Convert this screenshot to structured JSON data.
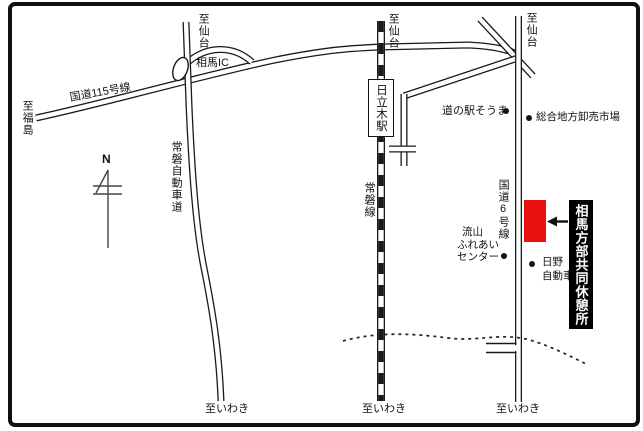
{
  "map": {
    "compass": {
      "label": "N"
    },
    "directions": {
      "to_sendai": "至仙台",
      "to_fukushima": "至福島",
      "to_iwaki": "至いわき"
    },
    "roads": {
      "route115": {
        "label": "国道115号線"
      },
      "expressway": {
        "label": "常磐自動車道"
      },
      "railway": {
        "label": "常磐線"
      },
      "route6": {
        "label": "国道6号線"
      }
    },
    "stations": {
      "soma_ic": {
        "label": "相馬IC"
      },
      "hitachiki": {
        "label": "日立木駅"
      }
    },
    "pois": {
      "michinoeki_soma": {
        "label": "道の駅そうま"
      },
      "wholesale_market": {
        "label": "総合地方卸売市場"
      },
      "nagareyama_center": {
        "lines": [
          "流山",
          "ふれあい",
          "センター"
        ]
      },
      "hino_motors": {
        "lines": [
          "日野",
          "自動車"
        ]
      }
    },
    "destination": {
      "label": "相馬方部共同休憩所"
    },
    "colors": {
      "highlight": "#e8110e",
      "ink": "#1a1a1a",
      "label_bg": "#000000",
      "label_fg": "#ffffff"
    }
  }
}
